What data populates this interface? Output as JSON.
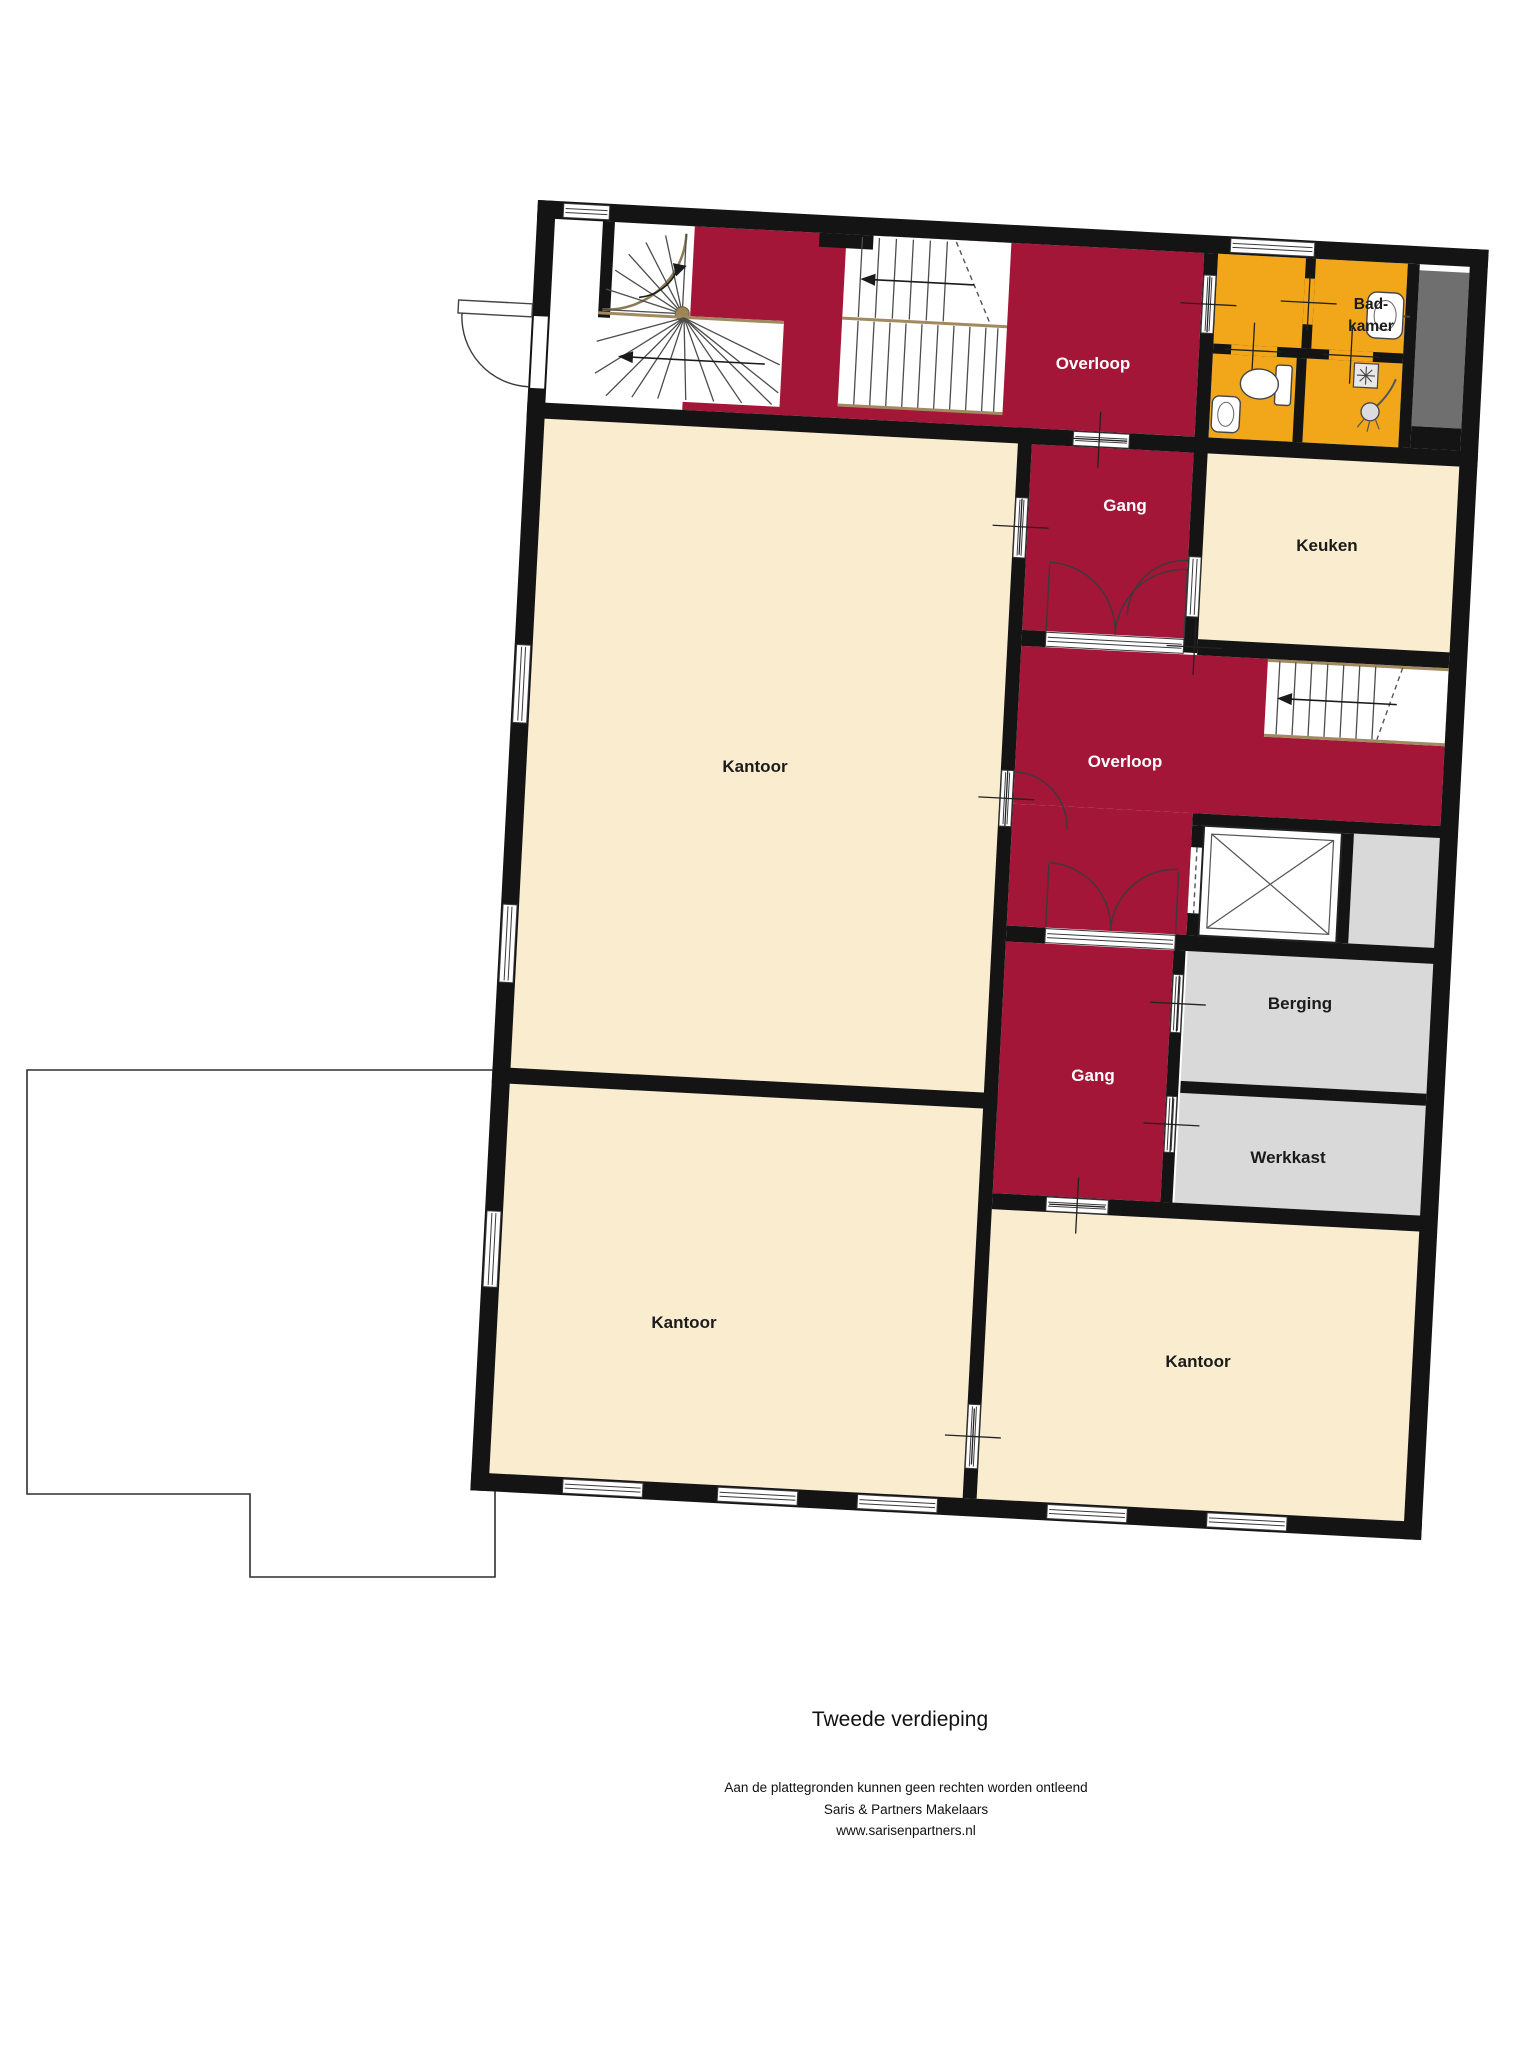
{
  "title": "Tweede verdieping",
  "footer": {
    "disclaimer": "Aan de plattegronden kunnen geen rechten worden ontleend",
    "company": "Saris & Partners Makelaars",
    "website": "www.sarisenpartners.nl"
  },
  "rooms": {
    "overloop_top": {
      "label": "Overloop"
    },
    "gang_top": {
      "label": "Gang"
    },
    "keuken": {
      "label": "Keuken"
    },
    "badkamer": {
      "label_line1": "Bad-",
      "label_line2": "kamer"
    },
    "overloop_mid": {
      "label": "Overloop"
    },
    "kantoor_groot": {
      "label": "Kantoor"
    },
    "berging": {
      "label": "Berging"
    },
    "gang_mid": {
      "label": "Gang"
    },
    "werkkast": {
      "label": "Werkkast"
    },
    "kantoor_links": {
      "label": "Kantoor"
    },
    "kantoor_rechts": {
      "label": "Kantoor"
    }
  },
  "colors": {
    "hallway_red": "#a31638",
    "room_cream": "#faeccf",
    "bathroom_amber": "#f2a71b",
    "storage_gray": "#d9d9d9",
    "shaft_gray": "#6f6f6f",
    "wall_black": "#141414"
  }
}
